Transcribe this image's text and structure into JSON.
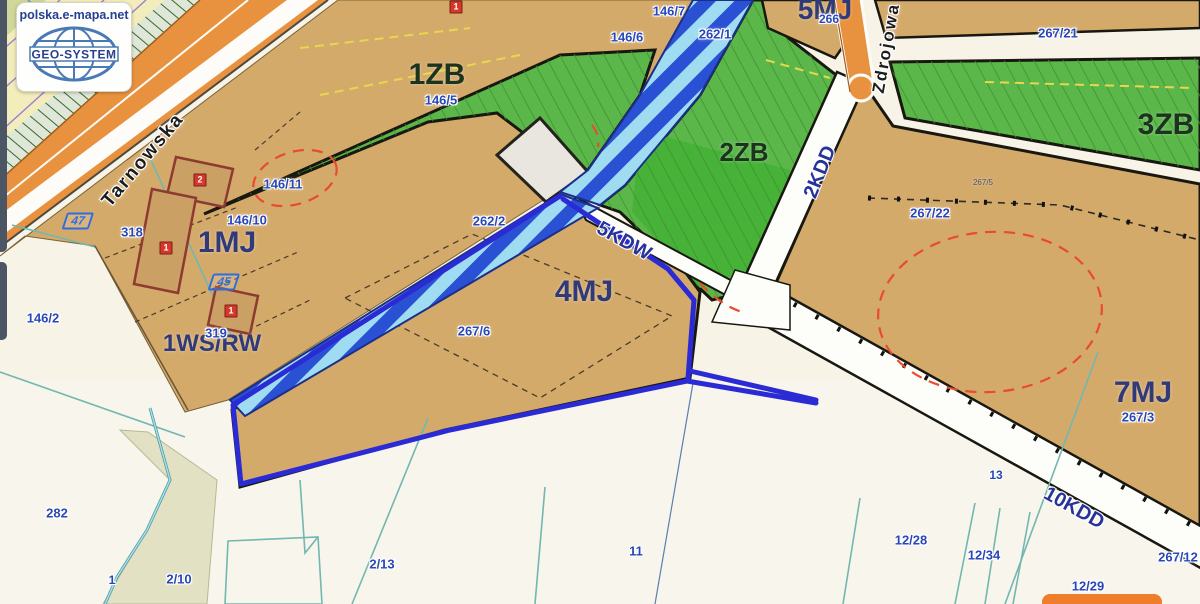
{
  "logo": {
    "site": "polska.e-mapa.net",
    "brand": "GEO-SYSTEM"
  },
  "map": {
    "colors": {
      "background_cream": "#f7f3e6",
      "zone_tan": "#d4aa6b",
      "zone_green": "#5cb74b",
      "zone_green_bright": "#46b238",
      "zone_yellow": "#f3edbb",
      "road_orange": "#e8923f",
      "channel_blue": "#2a50d4",
      "channel_light": "#9fdcf2",
      "selection_blue": "#2b2bd6",
      "parcel_label_blue": "#2948b8",
      "red_dashed": "#e84b2e",
      "building_red": "#8d3a30",
      "teal_line": "#72b7b0"
    },
    "labels": [
      {
        "name": "street-tarnowska",
        "text": "Tarnowska",
        "x": 143,
        "y": 160,
        "rot": -50,
        "size": 19,
        "kind": "street"
      },
      {
        "name": "street-zdrojowa",
        "text": "Zdrojowa",
        "x": 886,
        "y": 48,
        "rot": -80,
        "size": 17,
        "kind": "street"
      },
      {
        "name": "zone-1zb",
        "text": "1ZB",
        "x": 437,
        "y": 75,
        "size": 30,
        "kind": "zone-green"
      },
      {
        "name": "zone-2zb",
        "text": "2ZB",
        "x": 744,
        "y": 152,
        "size": 26,
        "kind": "zone-green"
      },
      {
        "name": "zone-3zb",
        "text": "3ZB",
        "x": 1166,
        "y": 125,
        "size": 30,
        "kind": "zone-green"
      },
      {
        "name": "zone-1mj",
        "text": "1MJ",
        "x": 227,
        "y": 243,
        "size": 30,
        "kind": "zone-res"
      },
      {
        "name": "zone-4mj",
        "text": "4MJ",
        "x": 584,
        "y": 292,
        "size": 30,
        "kind": "zone-res"
      },
      {
        "name": "zone-5mj",
        "text": "5MJ",
        "x": 825,
        "y": 10,
        "size": 28,
        "kind": "zone-res"
      },
      {
        "name": "zone-7mj",
        "text": "7MJ",
        "x": 1143,
        "y": 393,
        "size": 30,
        "kind": "zone-res"
      },
      {
        "name": "zone-1ws-rw",
        "text": "1WS/RW",
        "x": 212,
        "y": 344,
        "size": 24,
        "kind": "zone-res"
      },
      {
        "name": "road-5kdw",
        "text": "5KDW",
        "x": 624,
        "y": 241,
        "rot": 29,
        "size": 20,
        "kind": "road"
      },
      {
        "name": "road-2kdd",
        "text": "2KDD",
        "x": 820,
        "y": 172,
        "rot": -68,
        "size": 20,
        "kind": "road"
      },
      {
        "name": "road-10kdd",
        "text": "10KDD",
        "x": 1074,
        "y": 508,
        "rot": 29,
        "size": 20,
        "kind": "road"
      },
      {
        "name": "parcel-146-7",
        "text": "146/7",
        "x": 669,
        "y": 11,
        "kind": "parcel"
      },
      {
        "name": "parcel-146-6",
        "text": "146/6",
        "x": 627,
        "y": 37,
        "kind": "parcel"
      },
      {
        "name": "parcel-262-1",
        "text": "262/1",
        "x": 715,
        "y": 34,
        "kind": "parcel"
      },
      {
        "name": "parcel-146-5",
        "text": "146/5",
        "x": 441,
        "y": 100,
        "kind": "parcel"
      },
      {
        "name": "parcel-146-11",
        "text": "146/11",
        "x": 283,
        "y": 184,
        "kind": "parcel"
      },
      {
        "name": "parcel-146-10",
        "text": "146/10",
        "x": 247,
        "y": 220,
        "kind": "parcel"
      },
      {
        "name": "parcel-318",
        "text": "318",
        "x": 132,
        "y": 232,
        "kind": "parcel"
      },
      {
        "name": "parcel-319",
        "text": "319",
        "x": 216,
        "y": 333,
        "kind": "parcel"
      },
      {
        "name": "parcel-146-2",
        "text": "146/2",
        "x": 43,
        "y": 318,
        "kind": "parcel"
      },
      {
        "name": "parcel-262-2",
        "text": "262/2",
        "x": 489,
        "y": 221,
        "kind": "parcel"
      },
      {
        "name": "parcel-267-6",
        "text": "267/6",
        "x": 474,
        "y": 331,
        "kind": "parcel"
      },
      {
        "name": "parcel-266",
        "text": "266",
        "x": 829,
        "y": 19,
        "size": 12,
        "kind": "parcel"
      },
      {
        "name": "parcel-267-21",
        "text": "267/21",
        "x": 1058,
        "y": 33,
        "kind": "parcel"
      },
      {
        "name": "parcel-267-22",
        "text": "267/22",
        "x": 930,
        "y": 213,
        "kind": "parcel"
      },
      {
        "name": "parcel-267-5",
        "text": "267/5",
        "x": 983,
        "y": 183,
        "size": 8,
        "kind": "parcel-sm"
      },
      {
        "name": "parcel-267-3",
        "text": "267/3",
        "x": 1138,
        "y": 417,
        "kind": "parcel"
      },
      {
        "name": "parcel-267-12",
        "text": "267/12",
        "x": 1178,
        "y": 557,
        "kind": "parcel"
      },
      {
        "name": "parcel-13",
        "text": "13",
        "x": 996,
        "y": 475,
        "size": 12,
        "kind": "parcel"
      },
      {
        "name": "parcel-282",
        "text": "282",
        "x": 57,
        "y": 513,
        "kind": "parcel"
      },
      {
        "name": "parcel-1",
        "text": "1",
        "x": 112,
        "y": 580,
        "size": 12,
        "kind": "parcel"
      },
      {
        "name": "parcel-2-10",
        "text": "2/10",
        "x": 179,
        "y": 579,
        "kind": "parcel"
      },
      {
        "name": "parcel-2-13",
        "text": "2/13",
        "x": 382,
        "y": 564,
        "kind": "parcel"
      },
      {
        "name": "parcel-11",
        "text": "11",
        "x": 636,
        "y": 551,
        "kind": "parcel"
      },
      {
        "name": "parcel-12-28",
        "text": "12/28",
        "x": 911,
        "y": 540,
        "kind": "parcel"
      },
      {
        "name": "parcel-12-34",
        "text": "12/34",
        "x": 984,
        "y": 555,
        "kind": "parcel"
      },
      {
        "name": "parcel-12-29",
        "text": "12/29",
        "x": 1088,
        "y": 586,
        "kind": "parcel"
      },
      {
        "name": "point-marker-47",
        "text": "47",
        "x": 78,
        "y": 221,
        "kind": "marker"
      },
      {
        "name": "point-marker-45",
        "text": "45",
        "x": 224,
        "y": 282,
        "kind": "marker"
      },
      {
        "name": "building-badge-2",
        "text": "2",
        "x": 200,
        "y": 180,
        "kind": "badge"
      },
      {
        "name": "building-badge-1a",
        "text": "1",
        "x": 166,
        "y": 248,
        "kind": "badge"
      },
      {
        "name": "building-badge-1b",
        "text": "1",
        "x": 231,
        "y": 311,
        "kind": "badge"
      },
      {
        "name": "building-badge-1c",
        "text": "1",
        "x": 456,
        "y": 7,
        "kind": "badge"
      }
    ]
  }
}
